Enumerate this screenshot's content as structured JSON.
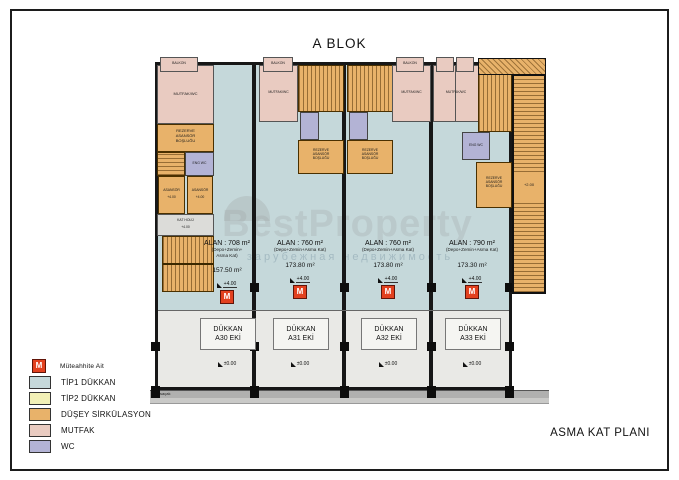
{
  "title": "A BLOK",
  "plan_name": "ASMA KAT PLANI",
  "watermark": {
    "brand": "BestProperty",
    "subtitle": "зарубежная недвижимость"
  },
  "legend": {
    "marker": {
      "symbol": "M",
      "label": "Müteahhite Ait",
      "color": "#e2411f"
    },
    "items": [
      {
        "label": "TİP1 DÜKKAN",
        "color": "#c5d8da"
      },
      {
        "label": "TİP2 DÜKKAN",
        "color": "#f2f0b6"
      },
      {
        "label": "DÜŞEY SİRKÜLASYON",
        "color": "#e8b26a"
      },
      {
        "label": "MUTFAK",
        "color": "#e9cbc1"
      },
      {
        "label": "WC",
        "color": "#b3b3d5"
      }
    ]
  },
  "units": [
    {
      "alan": "ALAN : 708 m²",
      "composition": "(Depo+Zemin+\nAsma Kat)",
      "mezzanine_area": "157.50 m²",
      "upper_level": "+4.00",
      "shop_line1": "DÜKKAN",
      "shop_line2": "A30 EKİ",
      "ground_level": "±0.00"
    },
    {
      "alan": "ALAN : 760 m²",
      "composition": "(Depo+Zemin+Asma Kat)",
      "mezzanine_area": "173.80 m²",
      "upper_level": "+4.00",
      "shop_line1": "DÜKKAN",
      "shop_line2": "A31 EKİ",
      "ground_level": "±0.00"
    },
    {
      "alan": "ALAN : 760 m²",
      "composition": "(Depo+Zemin+Asma Kat)",
      "mezzanine_area": "173.80 m²",
      "upper_level": "+4.00",
      "shop_line1": "DÜKKAN",
      "shop_line2": "A32 EKİ",
      "ground_level": "±0.00"
    },
    {
      "alan": "ALAN : 790 m²",
      "composition": "(Depo+Zemin+Asma Kat)",
      "mezzanine_area": "173.30 m²",
      "upper_level": "+4.00",
      "shop_line1": "DÜKKAN",
      "shop_line2": "A33 EKİ",
      "ground_level": "±0.00"
    }
  ],
  "rooms": {
    "reserve_shaft": "REZERVE\nASANSÖR\nBOŞLUĞU",
    "elevator": "ASANSÖR",
    "elevator_level": "+4.00",
    "hall": "KAT HOLÜ",
    "hall_level": "+4.00",
    "kitchen_wc": "MUTFAK/WC",
    "balcony": "BALKON",
    "wc": "ENG WC",
    "ext_stair_level": "+2.00",
    "eave": "saçak"
  }
}
